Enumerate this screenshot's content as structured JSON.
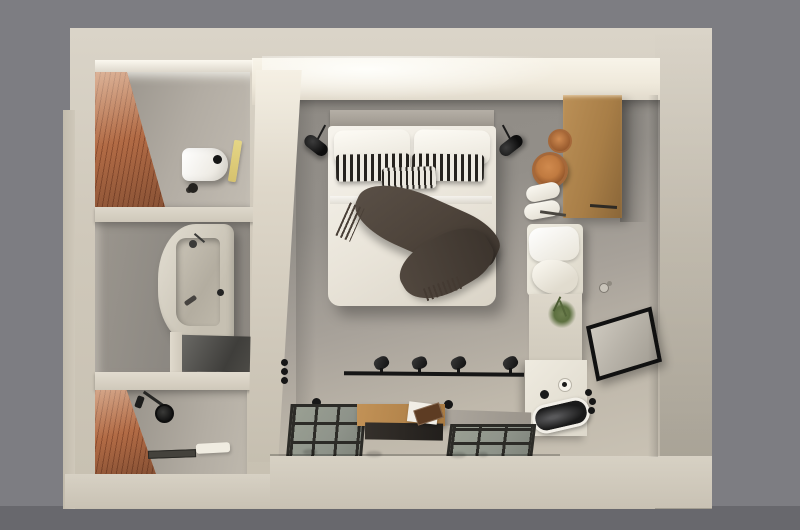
{
  "meta": {
    "title": "Bird's-eye 3D render of a studio bedroom suite",
    "view": "top-down architectural visualization",
    "rooms": {
      "bedroom": "Bedroom",
      "wc": "Toilet room",
      "bathroom": "Bathroom",
      "shower": "Shower room"
    }
  },
  "objects": {
    "bed": "Double bed with white duvet",
    "pillow_left": "White pillow",
    "pillow_right": "White pillow",
    "cushion_left": "Black and white striped cushion",
    "cushion_right": "Black and white striped cushion",
    "cushion_center": "Small striped cushion",
    "throw": "Dark fringed throw blanket",
    "headboard": "Grey headboard",
    "lamp_left": "Black wall reading lamp",
    "lamp_right": "Black wall reading lamp",
    "wardrobe": "Wooden wardrobe cabinet",
    "basket_large": "Rattan basket",
    "basket_small": "Rattan basket",
    "towels": "Folded white towels",
    "bench": "Storage bench with white cushions",
    "plant": "Green plant",
    "mirror": "Black-framed leaning mirror",
    "vanity": "White washbasin counter",
    "sink": "Black oval basin",
    "hooks": "Black wall hooks",
    "rail": "Black rail with four spotlights",
    "table": "Wooden coffee table with dark tray",
    "glass_left": "Glass floor panel",
    "glass_right": "Glass floor panel",
    "walk_slab": "Concrete walkway slab",
    "toilet": "Wall-hung toilet",
    "toilet_brush": "Toilet brush",
    "towel_hanging": "Yellow hanging towel",
    "bathtub": "Stone bathtub with dark faucet",
    "bath_counter": "Vanity with dark glass top",
    "shower_set": "Black shower fixture",
    "shower_drain": "Linear floor drain",
    "bath_mat": "White bath mat",
    "floor_dots": "Recessed floor spots",
    "knobs": "Black wall knobs"
  },
  "colors": {
    "bg": "#7d7d82",
    "bgDark": "#68686d",
    "wall": "#cfc8ba",
    "wallLit": "#f8f4e9",
    "wallDeep": "#b9b2a4",
    "floorGrey": "#8e8a84",
    "floorMid": "#a8a29a",
    "floorLight": "#c9c2b4",
    "brick": "#b26b45",
    "brickDark": "#8e4f31",
    "brickLight": "#c8805a",
    "wood": "#a87e47",
    "woodDark": "#8a6638",
    "woodLight": "#bb9057",
    "linen": "#f4f1e9",
    "linenShade": "#ddd7ca",
    "stripe": "#26231f",
    "throw": "#4e443b",
    "throwDark": "#3c342d",
    "black": "#161616",
    "glassFloor": "#8e938a",
    "glassFrame": "#2c2b27",
    "towelYellow": "#e5d686",
    "plantGreen": "#5d7040",
    "rattan": "#c07a40",
    "rattanDark": "#92552a",
    "mirrorGlass": "#b9b4aa"
  }
}
